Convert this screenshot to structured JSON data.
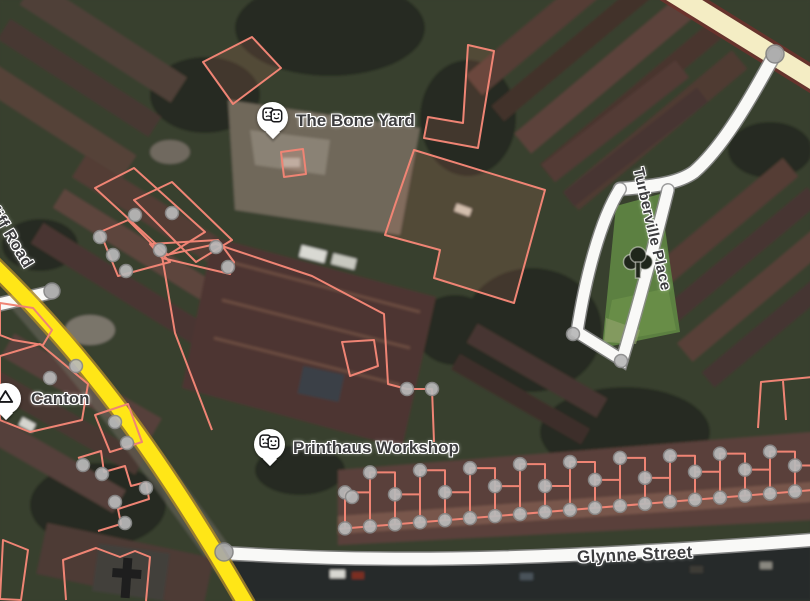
{
  "map": {
    "view": "satellite",
    "road_labels": {
      "cardiff_road": "Cardiff Road",
      "glynne_street": "Glynne Street",
      "turberville_place": "Turberville Place"
    },
    "pois": {
      "bone_yard": {
        "label": "The Bone Yard",
        "icon": "theater-masks-icon"
      },
      "printhaus": {
        "label": "Printhaus Workshop",
        "icon": "theater-masks-icon"
      },
      "canton": {
        "label": "Canton",
        "icon": "triangle-icon"
      }
    },
    "park": {
      "icon": "tree-icon"
    },
    "colors": {
      "primary_road": "#FFE617",
      "primary_road_casing": "#A8862A",
      "secondary_road": "#F4EDC4",
      "secondary_road_casing": "#6E312B",
      "minor_road": "#F9F9F7",
      "minor_road_casing": "#8C8C8C",
      "building_outline": "#EF8474",
      "vertex_dot": "#B9B9B9",
      "vertex_dot_border": "#8A8A8A",
      "junction_dot": "#A9A9A9",
      "junction_dot_border": "#828282",
      "park_green": "#5C8041",
      "label_text": "#3C3C3E"
    }
  }
}
